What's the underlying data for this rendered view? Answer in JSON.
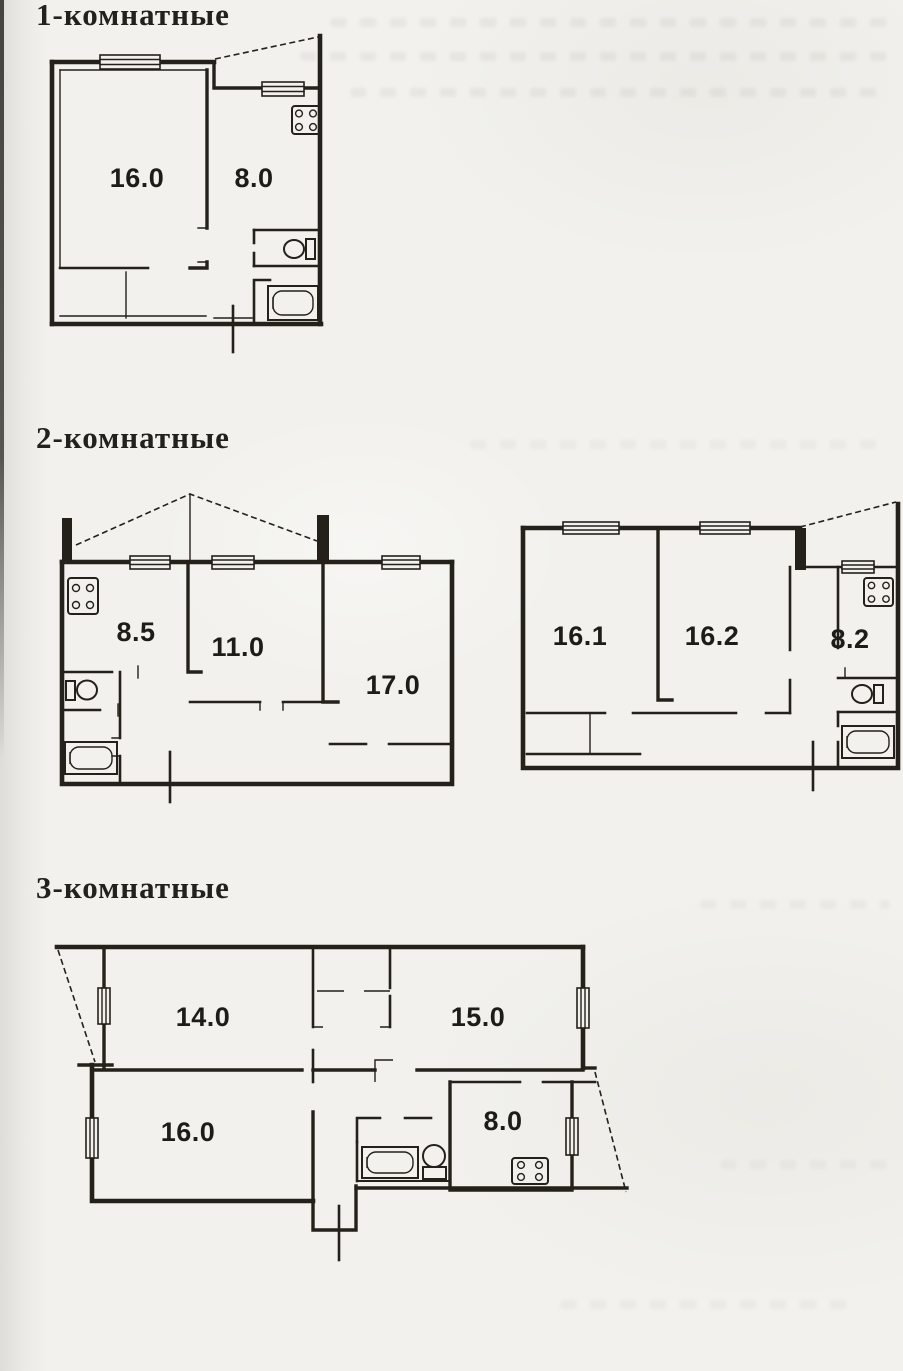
{
  "page": {
    "ink_color": "#232119",
    "paper_color": "#f2f1ed"
  },
  "sections": [
    {
      "title": "1-комнатные",
      "plans": [
        {
          "name": "one-room-plan",
          "rooms": [
            {
              "label": "16.0"
            },
            {
              "label": "8.0"
            }
          ]
        }
      ]
    },
    {
      "title": "2-комнатные",
      "plans": [
        {
          "name": "two-room-plan-left",
          "rooms": [
            {
              "label": "8.5"
            },
            {
              "label": "11.0"
            },
            {
              "label": "17.0"
            }
          ]
        },
        {
          "name": "two-room-plan-right",
          "rooms": [
            {
              "label": "16.1"
            },
            {
              "label": "16.2"
            },
            {
              "label": "8.2"
            }
          ]
        }
      ]
    },
    {
      "title": "3-комнатные",
      "plans": [
        {
          "name": "three-room-plan",
          "rooms": [
            {
              "label": "14.0"
            },
            {
              "label": "15.0"
            },
            {
              "label": "16.0"
            },
            {
              "label": "8.0"
            }
          ]
        }
      ]
    }
  ]
}
